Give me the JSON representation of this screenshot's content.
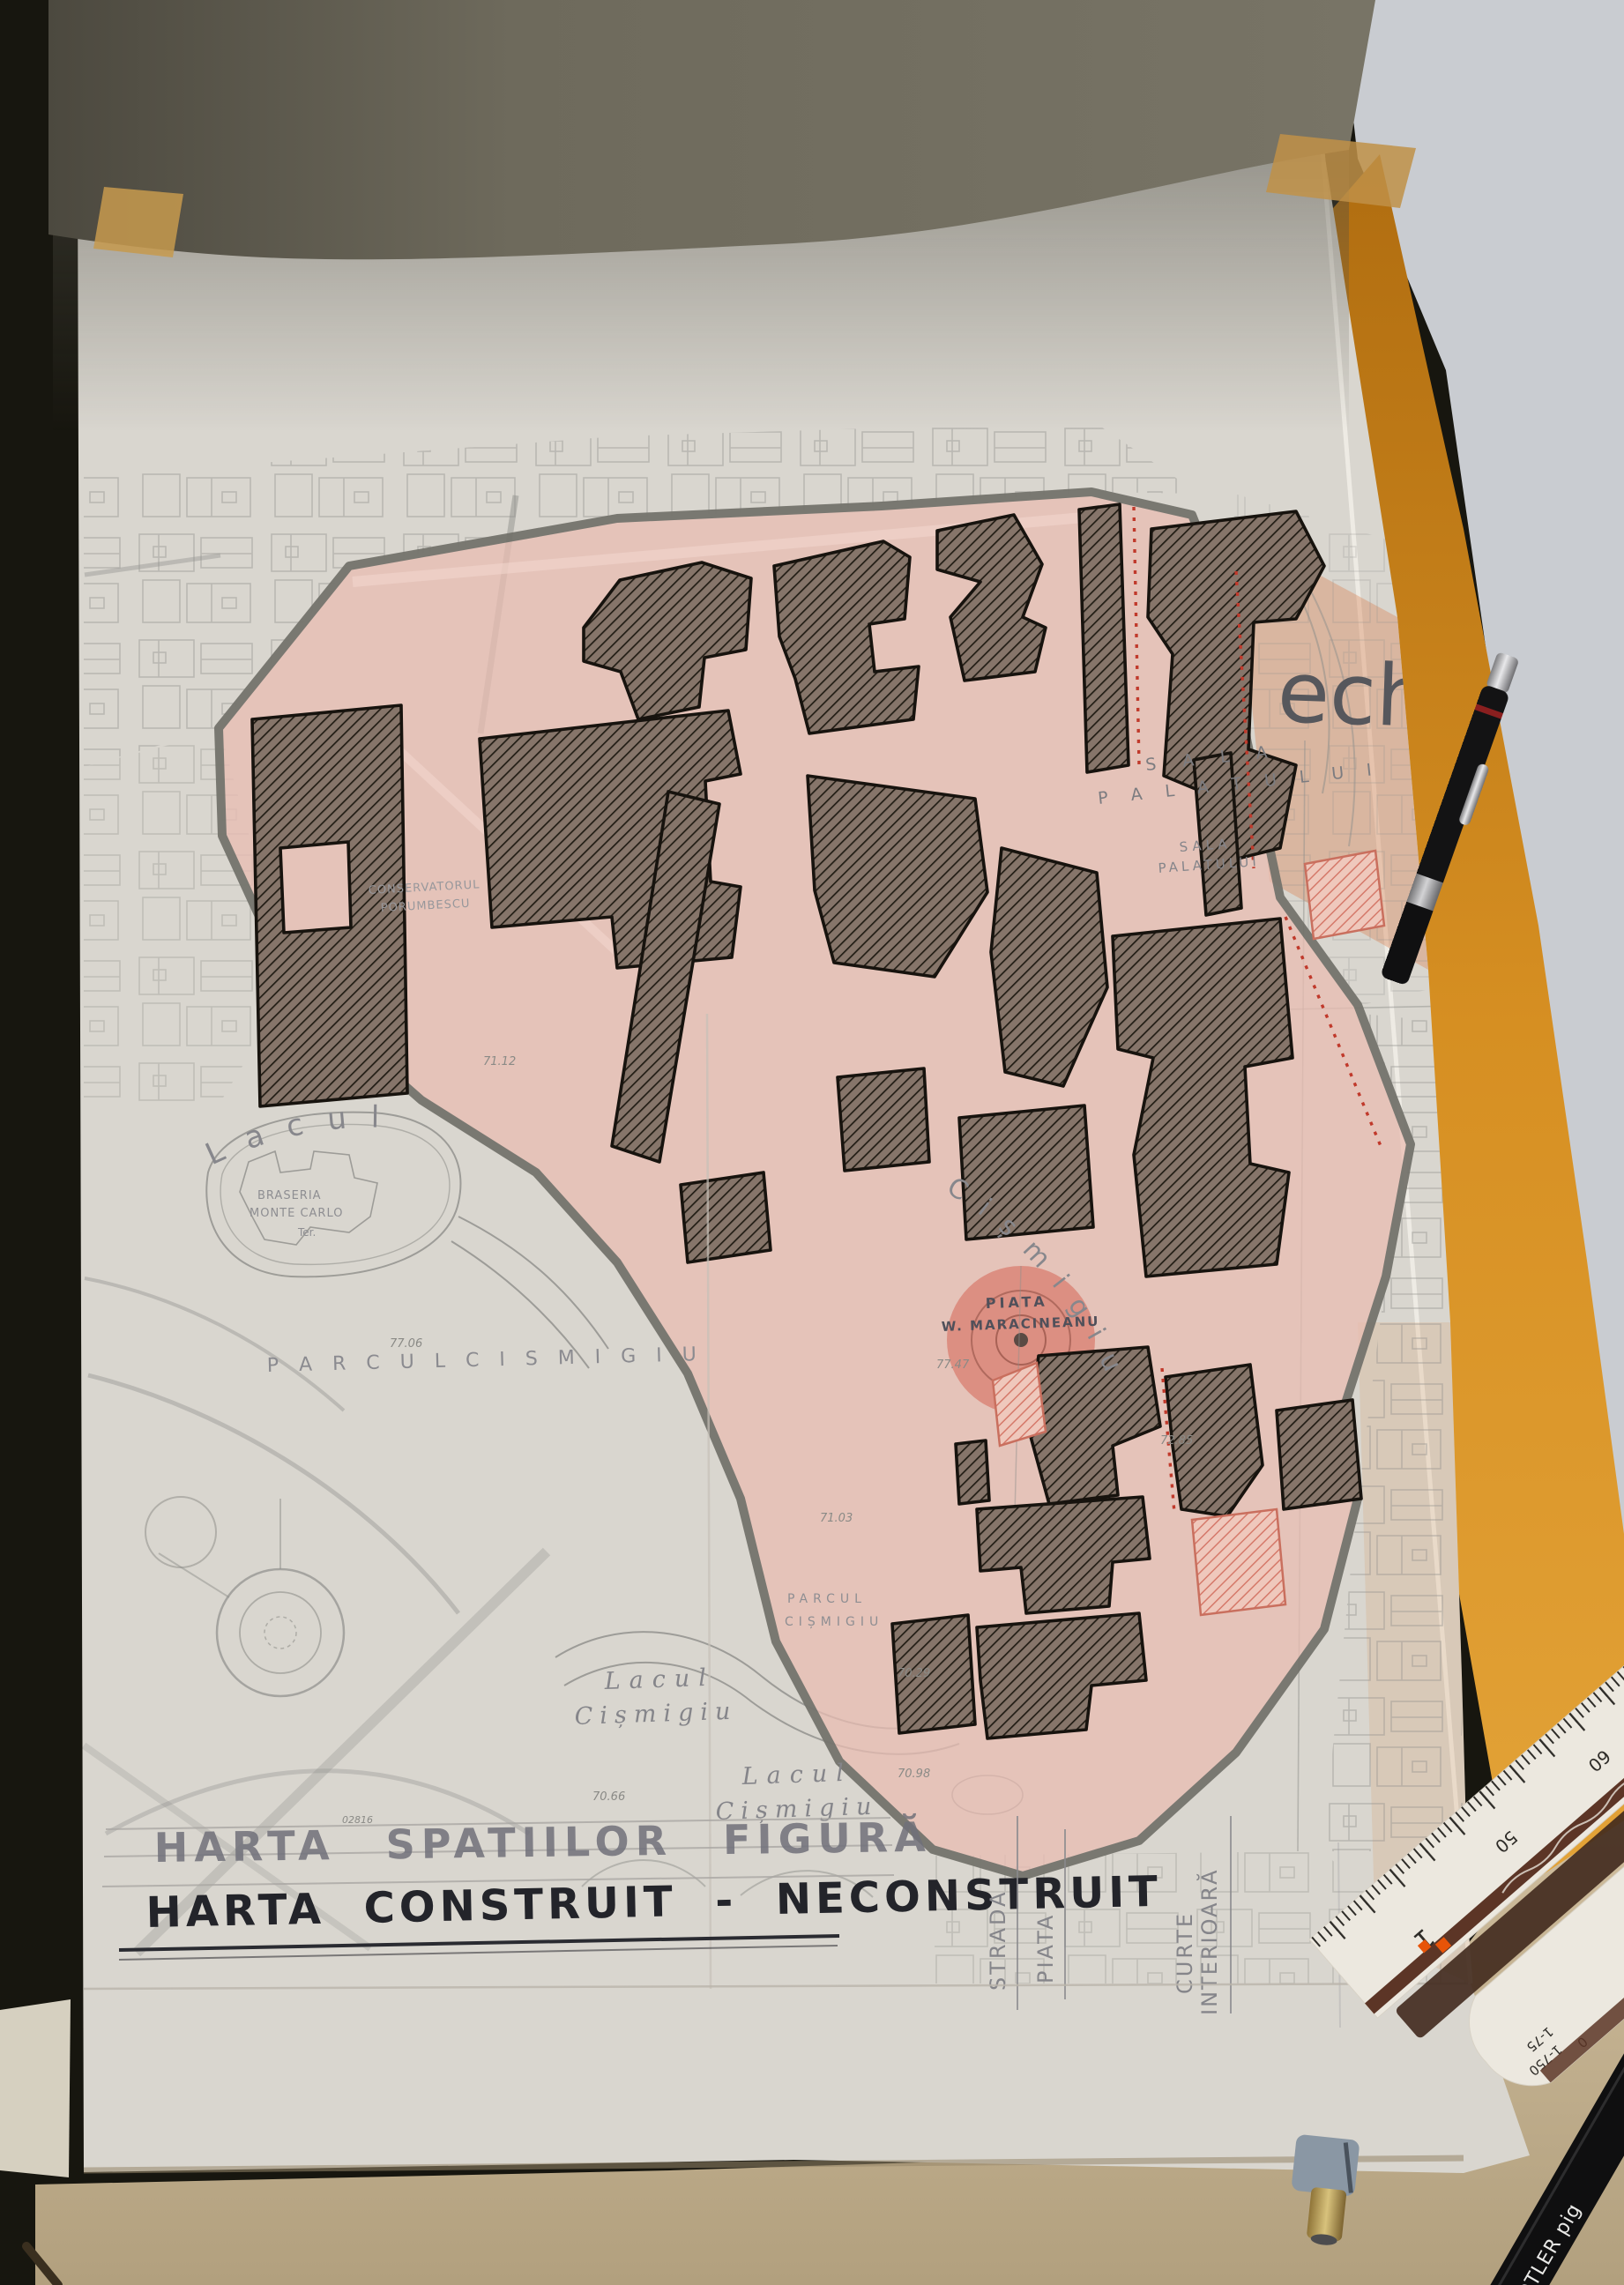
{
  "titles": {
    "line1": "HARTA   SPATIILOR   FIGURĂ",
    "line2": "HARTA   CONSTRUIT - NECONSTRUIT"
  },
  "legend": {
    "labels": [
      "STRADA",
      "PIATA",
      "CURTE",
      "INTERIOARĂ"
    ]
  },
  "map_labels": {
    "big_overlay": "ech",
    "sala1a": "S A L A",
    "sala1b": "P A L A T U L U I",
    "sala2a": "SALA",
    "sala2b": "PALATULUI",
    "lacul_arc": "L a c u l",
    "cismigiu_arc": "C i ș m i g i u",
    "island1": "BRASERIA",
    "island2": "MONTE CARLO",
    "island3": "Ter.",
    "parcul_main": "P A R C U L    C I S M I G I U",
    "parcul_small1": "PARCUL",
    "parcul_small2": "CIȘMIGIU",
    "lake_a1": "Lacul",
    "lake_a2": "Cișmigiu",
    "lake_b1": "Lacul",
    "lake_b2": "Cișmigiu",
    "plaza1": "PIATA",
    "plaza2": "W. MARACINEANU",
    "conserv1": "CONSERVATORUL",
    "conserv2": "PORUMBESCU"
  },
  "elevations": [
    "77.06",
    "77.47",
    "70.29",
    "70.98",
    "70.66",
    "71.03",
    "72.85",
    "71.12",
    "02816"
  ],
  "ruler": {
    "scale_numbers": [
      "100",
      "60",
      "50",
      "1",
      "30",
      "35"
    ],
    "end_labels": [
      "1-75",
      "1-750",
      "0"
    ]
  },
  "stationery": {
    "pen_brand_fragment": "EDTLER pig"
  },
  "colors": {
    "zone_pink": "#e9bdb2",
    "plaza_red": "#dc8a7c",
    "building_ink": "#17130e",
    "boundary_gray": "#74736c",
    "pencil_gray": "#8d8d90",
    "orange_folder": "#d2891f",
    "desk_tan": "#c2b18f",
    "title_ink": "#26272e"
  }
}
